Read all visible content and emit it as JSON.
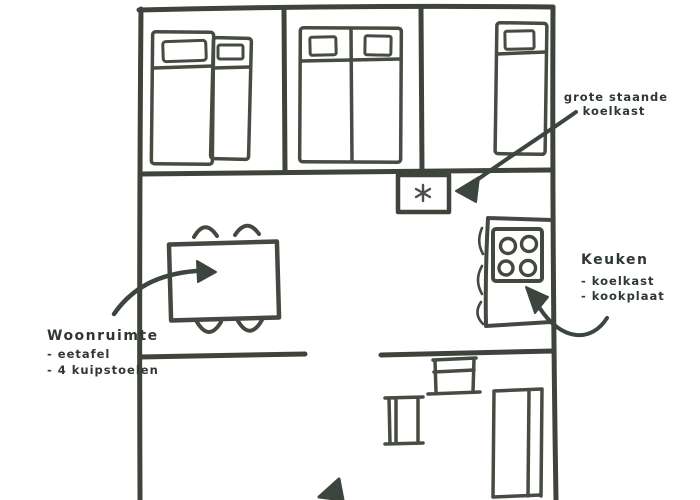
{
  "page": {
    "type": "hand-drawn floor plan sketch",
    "background": "#ffffff",
    "ink_color": "#3e443c",
    "text_color": "#2f3831"
  },
  "labels": {
    "fridge_note": {
      "line1": "grote staande",
      "line2": "koelkast"
    },
    "kitchen": {
      "title": "Keuken",
      "items": [
        "- koelkast",
        "- kookplaat"
      ]
    },
    "living": {
      "title": "Woonruimte",
      "items": [
        "- eetafel",
        "- 4 kuipstoelen"
      ]
    }
  },
  "symbols": {
    "freezer": "snowflake"
  }
}
